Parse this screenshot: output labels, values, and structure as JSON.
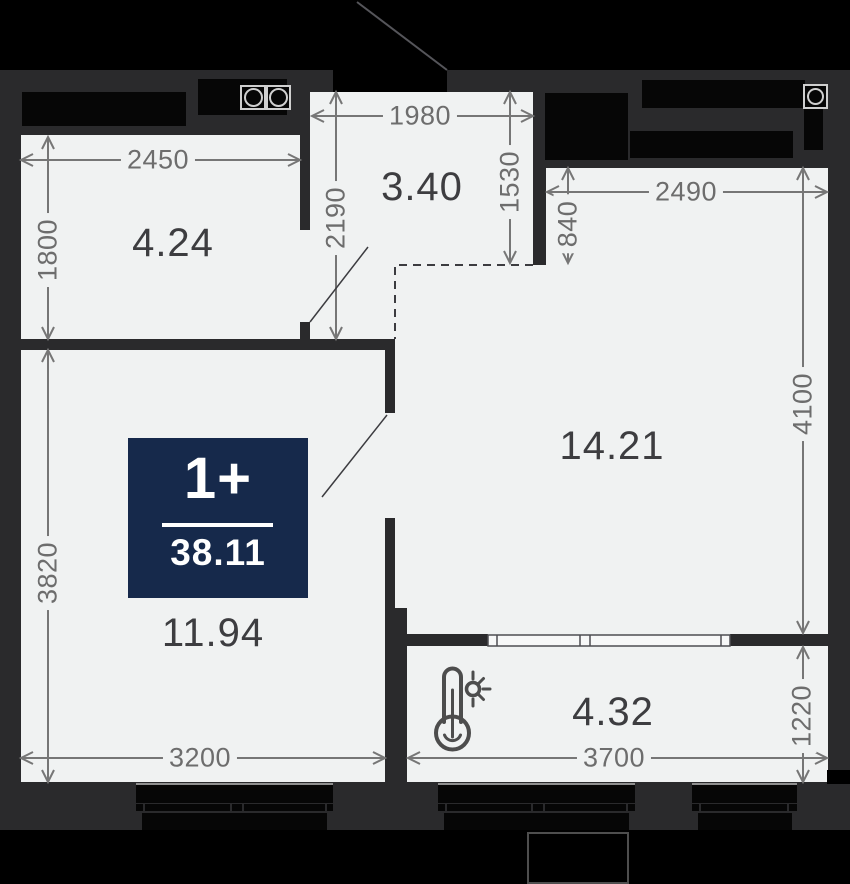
{
  "badge": {
    "rooms_label": "1+",
    "total_area": "38.11"
  },
  "rooms": {
    "kitchen_area": "4.24",
    "hall_area": "3.40",
    "living_area": "14.21",
    "bedroom_area": "11.94",
    "loggia_area": "4.32"
  },
  "dimensions": {
    "d2450": "2450",
    "d1800": "1800",
    "d1980": "1980",
    "d2190": "2190",
    "d1530": "1530",
    "d840": "840",
    "d2490": "2490",
    "d4100": "4100",
    "d3820": "3820",
    "d3200": "3200",
    "d3700": "3700",
    "d1220": "1220"
  },
  "icons": {
    "loggia_heating": "thermometer-sun-icon",
    "stove": "stove-burners-icon",
    "washer": "washing-machine-icon"
  },
  "colors": {
    "badge_bg": "#16294b",
    "wall": "#2a2a2c",
    "room_bg": "#f0f2f2",
    "outside": "#000000",
    "dim_text": "#6d6d6d",
    "area_text": "#3d3d40"
  }
}
